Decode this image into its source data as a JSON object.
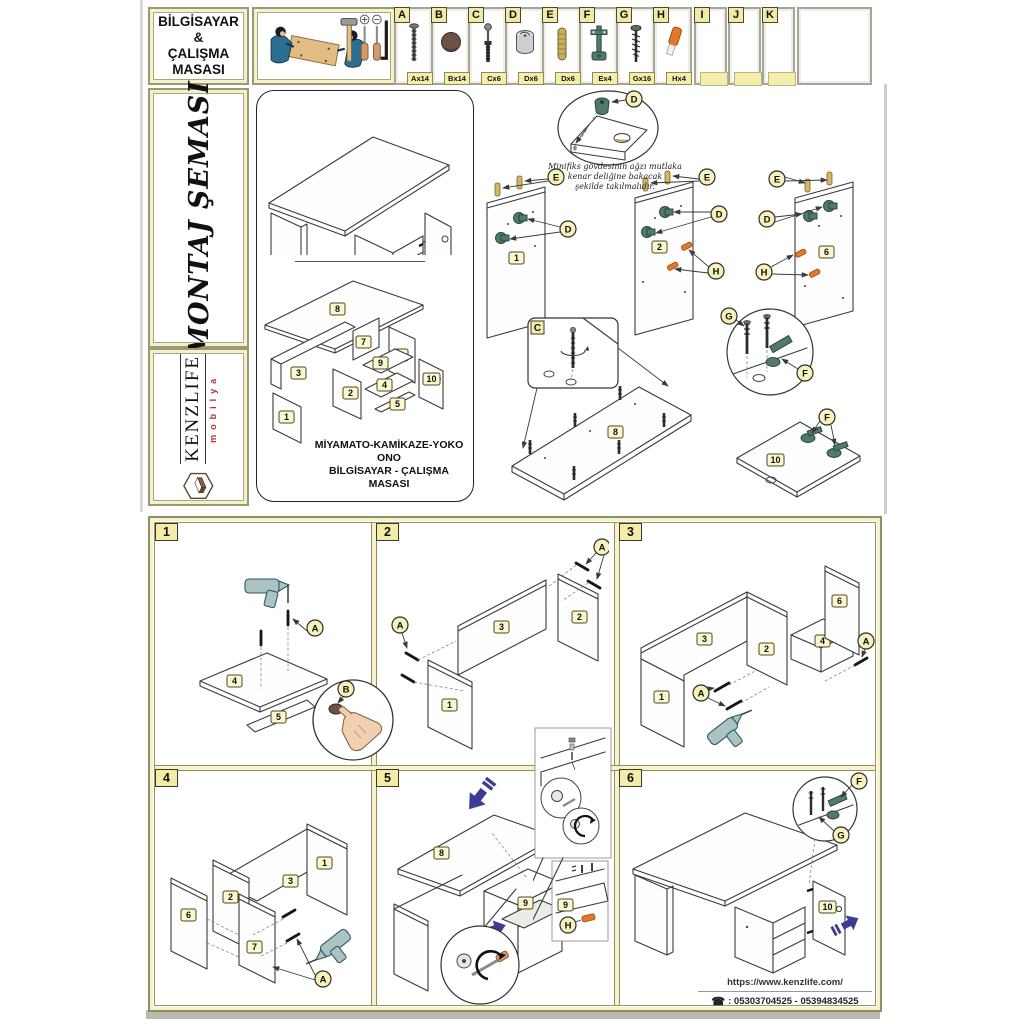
{
  "title_box": {
    "lines": [
      "BİLGİSAYAR",
      "&",
      "ÇALIŞMA",
      "MASASI"
    ]
  },
  "hardware": {
    "items": [
      {
        "letter": "A",
        "qty": "Ax14",
        "icon": "long-screw"
      },
      {
        "letter": "B",
        "qty": "Bx14",
        "icon": "cover-cap"
      },
      {
        "letter": "C",
        "qty": "Cx6",
        "icon": "cam-bolt"
      },
      {
        "letter": "D",
        "qty": "Dx6",
        "icon": "minifix-cam"
      },
      {
        "letter": "E",
        "qty": "Dx6",
        "icon": "wood-dowel"
      },
      {
        "letter": "F",
        "qty": "Ex4",
        "icon": "hinge"
      },
      {
        "letter": "G",
        "qty": "Gx16",
        "icon": "chipboard-screw"
      },
      {
        "letter": "H",
        "qty": "Hx4",
        "icon": "shelf-pin"
      },
      {
        "letter": "I",
        "qty": ""
      },
      {
        "letter": "J",
        "qty": ""
      },
      {
        "letter": "K",
        "qty": ""
      }
    ]
  },
  "sidebar": {
    "schema_title": "MONTAJ ŞEMASI",
    "brand": "KENZLIFE",
    "brand_sub": "mobilya"
  },
  "overview": {
    "product_lines": [
      "MİYAMATO-KAMİKAZE-YOKO ONO",
      "BİLGİSAYAR - ÇALIŞMA",
      "MASASI"
    ],
    "note_lines": [
      "Minifiks gövdesinin ağzı mutlaka",
      "kenar deliğine bakacak",
      "şekilde takılmalıdır."
    ]
  },
  "letters": {
    "A": "A",
    "B": "B",
    "C": "C",
    "D": "D",
    "E": "E",
    "F": "F",
    "G": "G",
    "H": "H"
  },
  "nums": {
    "n1": "1",
    "n2": "2",
    "n3": "3",
    "n4": "4",
    "n5": "5",
    "n6": "6",
    "n7": "7",
    "n8": "8",
    "n9": "9",
    "n10": "10"
  },
  "steps": {
    "s1": "1",
    "s2": "2",
    "s3": "3",
    "s4": "4",
    "s5": "5",
    "s6": "6"
  },
  "footer": {
    "website": "https://www.kenzlife.com/",
    "phone_icon": "☎",
    "phones": ": 05303704525 - 05394834525"
  },
  "colors": {
    "frame": "#8f8f62",
    "tag": "#f3eca9",
    "blue": "#3c3c92",
    "brand_red": "#b03030",
    "fitting_teal": "#527a68",
    "dowel": "#d2b766",
    "pin_orange": "#e6762a"
  }
}
